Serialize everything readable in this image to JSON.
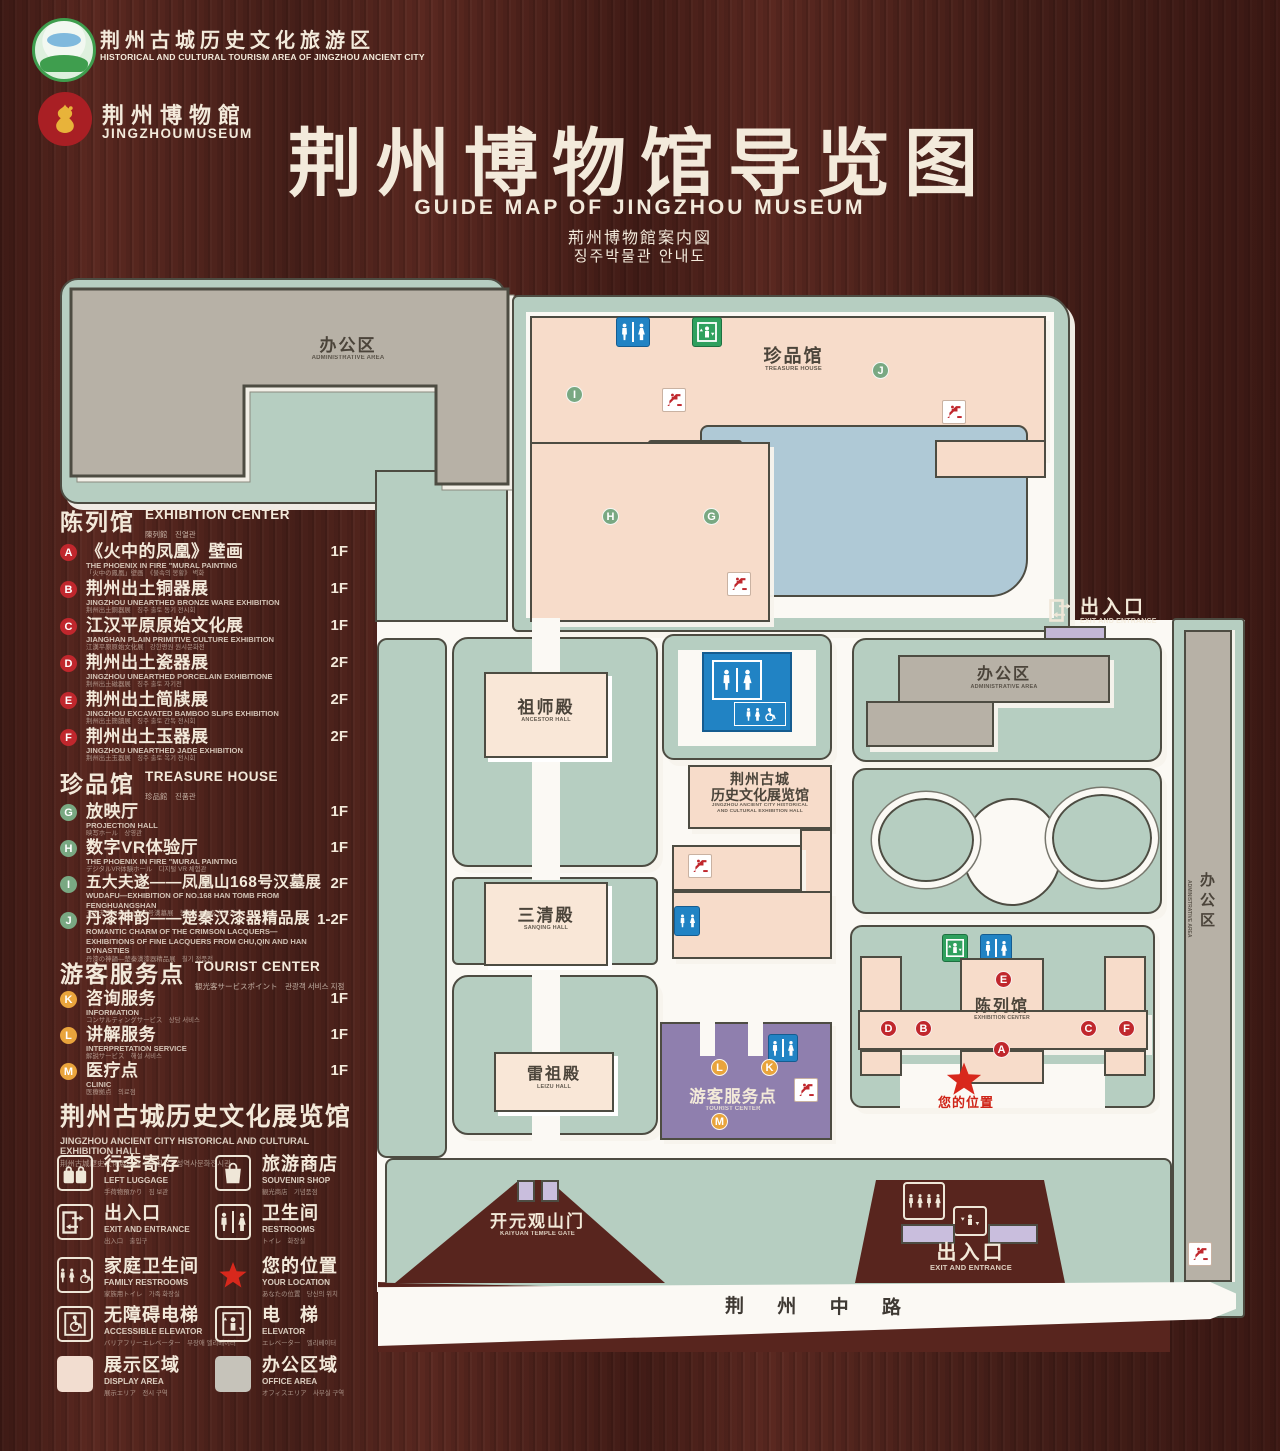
{
  "header": {
    "logo1": {
      "zh": "荆州古城历史文化旅游区",
      "en": "HISTORICAL AND CULTURAL TOURISM AREA OF JINGZHOU ANCIENT CITY"
    },
    "logo2": {
      "zh": "荆州博物館",
      "en": "JINGZHOUMUSEUM"
    },
    "title": "荆州博物馆导览图",
    "subtitle_en": "GUIDE MAP OF JINGZHOU MUSEUM",
    "subtitle_ja": "荊州博物館案内図",
    "subtitle_ko": "징주박물관 안내도"
  },
  "sidebar": {
    "sections": [
      {
        "zh": "陈列馆",
        "en": "EXHIBITION CENTER",
        "sub": "陳列館　진열관",
        "items": [
          {
            "letter": "A",
            "zh": "《火中的凤凰》壁画",
            "en": "THE PHOENIX IN FIRE \"MURAL PAINTING",
            "sub": "「火中の鳳凰」壁画　《불속의 봉황》 벽화",
            "floor": "1F"
          },
          {
            "letter": "B",
            "zh": "荆州出土铜器展",
            "en": "JINGZHOU UNEARTHED BRONZE WARE EXHIBITION",
            "sub": "荆州出土銅器展　징주 출토 동기 전시회",
            "floor": "1F"
          },
          {
            "letter": "C",
            "zh": "江汉平原原始文化展",
            "en": "JIANGHAN PLAIN PRIMITIVE CULTURE EXHIBITION",
            "sub": "江漢平原原始文化展　강한평원 원시문화전",
            "floor": "1F"
          },
          {
            "letter": "D",
            "zh": "荆州出土瓷器展",
            "en": "JINGZHOU UNEARTHED PORCELAIN EXHIBITIONE",
            "sub": "荆州出土磁器展　징주 출토 자기전",
            "floor": "2F"
          },
          {
            "letter": "E",
            "zh": "荆州出土简牍展",
            "en": "JINGZHOU EXCAVATED BAMBOO SLIPS EXHIBITION",
            "sub": "荆州出土簡牘展　징주 출토 간독 전시회",
            "floor": "2F"
          },
          {
            "letter": "F",
            "zh": "荆州出土玉器展",
            "en": "JINGZHOU UNEARTHED JADE EXHIBITION",
            "sub": "荆州出土玉器展　징주 출토 옥기 전시회",
            "floor": "2F"
          }
        ]
      },
      {
        "zh": "珍品馆",
        "en": "TREASURE HOUSE",
        "sub": "珍品館　진품관",
        "items": [
          {
            "letter": "G",
            "zh": "放映厅",
            "en": "PROJECTION HALL",
            "sub": "映写ホール　상영관",
            "floor": "1F"
          },
          {
            "letter": "H",
            "zh": "数字VR体验厅",
            "en": "THE PHOENIX IN FIRE \"MURAL PAINTING",
            "sub": "デジタルVR体験ホール　디지털 VR 체험관",
            "floor": "1F"
          },
          {
            "letter": "I",
            "zh": "五大夫遂——凤凰山168号汉墓展",
            "en": "WUDAFU—EXHIBITION OF NO.168 HAN TOMB FROM FENGHUANGSHAN",
            "sub": "五大夫遂—鳳凰山168号漢墓展　봉황산 168호 한묘전",
            "floor": "2F"
          },
          {
            "letter": "J",
            "zh": "丹漆神韵——楚秦汉漆器精品展",
            "en": "ROMANTIC CHARM OF THE CRIMSON LACQUERS— EXHIBITIONS OF FINE LACQUERS FROM CHU,QIN AND HAN DYNASTIES",
            "sub": "丹漆の神韻—楚秦漢漆器精品展　칠기 정품전",
            "floor": "1-2F"
          }
        ]
      },
      {
        "zh": "游客服务点",
        "en": "TOURIST CENTER",
        "sub": "観光客サービスポイント　관광객 서비스 지점",
        "items": [
          {
            "letter": "K",
            "zh": "咨询服务",
            "en": "INFORMATION",
            "sub": "コンサルティングサービス　상담 서비스",
            "floor": "1F"
          },
          {
            "letter": "L",
            "zh": "讲解服务",
            "en": "INTERPRETATION SERVICE",
            "sub": "解説サービス　해설 서비스",
            "floor": "1F"
          },
          {
            "letter": "M",
            "zh": "医疗点",
            "en": "CLINIC",
            "sub": "医療拠点　의료점",
            "floor": "1F"
          }
        ]
      }
    ],
    "hall": {
      "zh": "荆州古城历史文化展览馆",
      "en": "JINGZHOU ANCIENT CITY HISTORICAL AND CULTURAL EXHIBITION HALL",
      "sub": "荆州古城歴史文化展示館　　징주고성역사문화전시관"
    }
  },
  "legend": {
    "items": [
      {
        "zh": "行李寄存",
        "en": "LEFT LUGGAGE",
        "sub": "手荷物預かり　짐 보관"
      },
      {
        "zh": "旅游商店",
        "en": "SOUVENIR SHOP",
        "sub": "観光商店　기념품점"
      },
      {
        "zh": "出入口",
        "en": "EXIT AND ENTRANCE",
        "sub": "出入口　출입구"
      },
      {
        "zh": "卫生间",
        "en": "RESTROOMS",
        "sub": "トイレ　화장실"
      },
      {
        "zh": "家庭卫生间",
        "en": "FAMILY RESTROOMS",
        "sub": "家族用トイレ　가족 화장실"
      },
      {
        "zh": "您的位置",
        "en": "YOUR LOCATION",
        "sub": "あなたの位置　당신의 위치"
      },
      {
        "zh": "无障碍电梯",
        "en": "ACCESSIBLE ELEVATOR",
        "sub": "バリアフリーエレベーター　무장애 엘리베이터"
      },
      {
        "zh": "电　梯",
        "en": "ELEVATOR",
        "sub": "エレベーター　엘리베이터"
      },
      {
        "zh": "展示区域",
        "en": "DISPLAY AREA",
        "sub": "展示エリア　전시 구역"
      },
      {
        "zh": "办公区域",
        "en": "OFFICE AREA",
        "sub": "オフィスエリア　사무실 구역"
      }
    ]
  },
  "map": {
    "admin_top": {
      "zh": "办公区",
      "en": "ADMINISTRATIVE AREA"
    },
    "treasure": {
      "zh": "珍品馆",
      "en": "TREASURE HOUSE"
    },
    "exit_right": {
      "zh": "出入口",
      "en": "EXIT AND ENTRANCE"
    },
    "admin_mid": {
      "zh": "办公区",
      "en": "ADMINISTRATIVE AREA"
    },
    "admin_side": {
      "zh": "办公区",
      "en": "ADMINISTRATIVE AREA"
    },
    "ancestor": {
      "zh": "祖师殿",
      "en": "ANCESTOR HALL"
    },
    "sanqing": {
      "zh": "三清殿",
      "en": "SANQING HALL"
    },
    "leizu": {
      "zh": "雷祖殿",
      "en": "LEIZU HALL"
    },
    "jz_hall": {
      "zh1": "荆州古城",
      "zh2": "历史文化展览馆",
      "en1": "JINGZHOU ANCIENT CITY HISTORICAL",
      "en2": "AND CULTURAL EXHIBITION HALL"
    },
    "tourist": {
      "zh": "游客服务点",
      "en": "TOURIST CENTER"
    },
    "exhibition": {
      "zh": "陈列馆",
      "en": "EXHIBITION CENTER"
    },
    "your_location": {
      "zh": "您的位置"
    },
    "kaiyuan": {
      "zh": "开元观山门",
      "en": "KAIYUAN TEMPLE GATE"
    },
    "exit_bottom": {
      "zh": "出入口",
      "en": "EXIT AND ENTRANCE"
    },
    "road": {
      "zh": "荆 州 中 路"
    },
    "badges": {
      "A": "A",
      "B": "B",
      "C": "C",
      "D": "D",
      "E": "E",
      "F": "F",
      "G": "G",
      "H": "H",
      "I": "I",
      "J": "J",
      "K": "K",
      "L": "L",
      "M": "M"
    }
  },
  "colors": {
    "wood": "#5a2820",
    "area_green": "#b6cec1",
    "building_gray": "#b7b1a6",
    "building_pink": "#f7dcca",
    "hall_cream": "#f9e7d7",
    "lake_blue": "#afc9d6",
    "purple": "#8f7fae",
    "gate_purple": "#c9bedd",
    "badge_red": "#c0272d",
    "badge_green": "#79a882",
    "badge_orange": "#e9a43c",
    "sign_blue": "#2183c4",
    "sign_green": "#2fa05e",
    "star_red": "#d8281c",
    "text_cream": "#f3e9da"
  }
}
